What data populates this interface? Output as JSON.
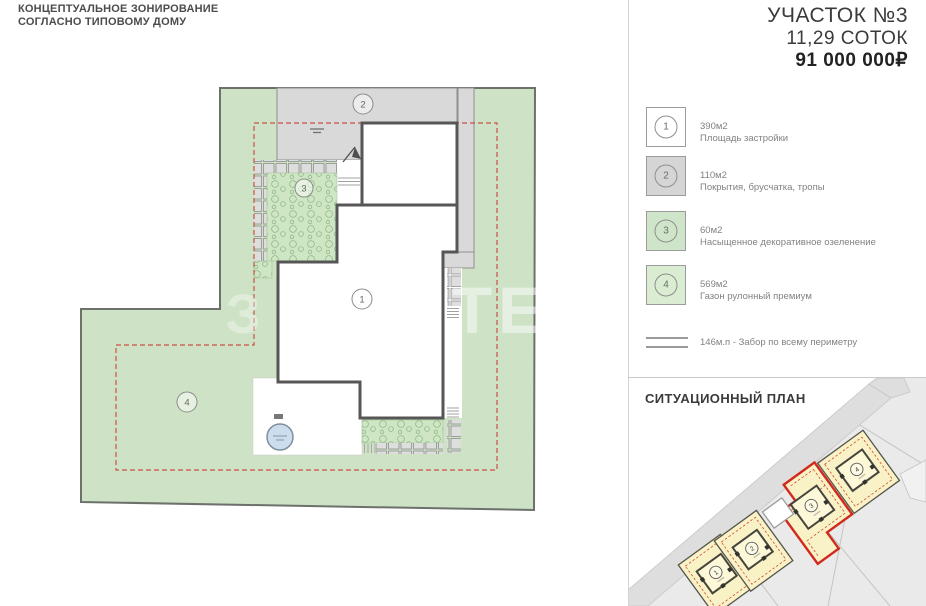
{
  "main_plan": {
    "title_line1": "КОНЦЕПТУАЛЬНОЕ ЗОНИРОВАНИЕ",
    "title_line2": "СОГЛАСНО ТИПОВОМУ ДОМУ",
    "zones": [
      {
        "num": "1"
      },
      {
        "num": "2"
      },
      {
        "num": "3"
      },
      {
        "num": "4"
      }
    ],
    "watermark_right": "ТЕ",
    "watermark_left": "З"
  },
  "panel": {
    "plot_title": "УЧАСТОК №3",
    "area": "11,29 СОТОК",
    "price": "91 000 000₽"
  },
  "legend": {
    "items": [
      {
        "num": "1",
        "area": "390м2",
        "label": "Площадь застройки",
        "color": "#ffffff"
      },
      {
        "num": "2",
        "area": "110м2",
        "label": "Покрытия, брусчатка, тропы",
        "color": "#d5d5d5"
      },
      {
        "num": "3",
        "area": "60м2",
        "label": "Насыщенное декоративное озеленение",
        "color": "#cfe5c9"
      },
      {
        "num": "4",
        "area": "569м2",
        "label": "Газон рулонный премиум",
        "color": "#daecd2"
      }
    ],
    "fence_label": "146м.п - Забор по всему периметру"
  },
  "situational": {
    "title": "СИТУАЦИОННЫЙ ПЛАН",
    "plots": [
      {
        "num": "1"
      },
      {
        "num": "2"
      },
      {
        "num": "3"
      },
      {
        "num": "4"
      }
    ],
    "highlighted_plot": "3"
  },
  "colors": {
    "lawn_green": "#cee2c5",
    "planting_green": "#cfe6c4",
    "driveway_gray": "#d9d9d9",
    "setback_red": "#c85246",
    "highlight_red": "#d12a1c",
    "plot_yellow": "#f9f2c6",
    "pool_blue": "#ccdeed"
  }
}
